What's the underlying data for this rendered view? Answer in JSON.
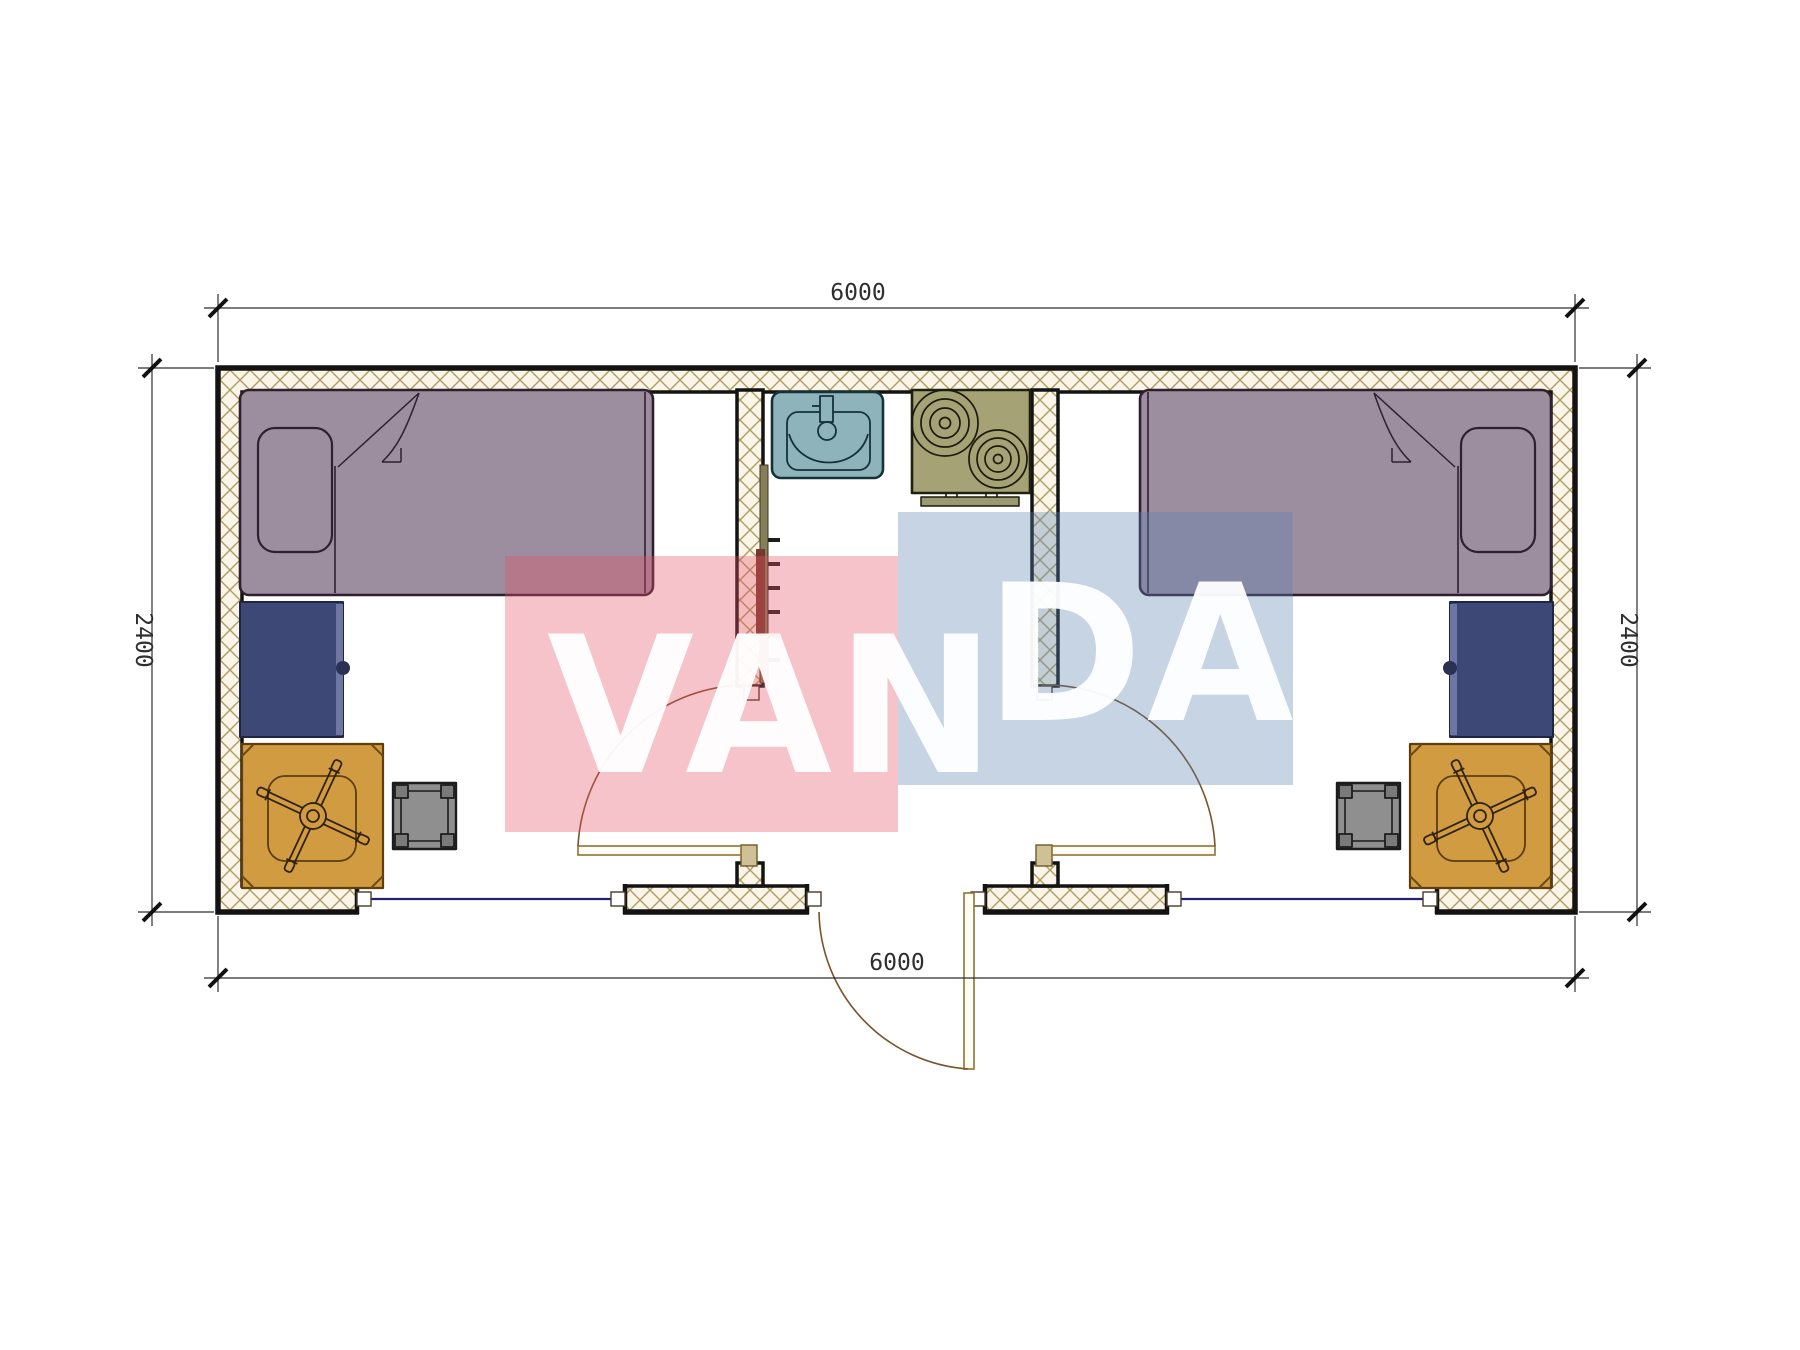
{
  "plan": {
    "dimensions": {
      "top": "6000",
      "bottom": "6000",
      "left": "2400",
      "right": "2400"
    },
    "watermark": {
      "part1": "VAN",
      "part2": "DA",
      "pink_color": "#e55468",
      "blue_color": "#5b83b1",
      "text_color": "#ffffff"
    },
    "colors": {
      "wall_hatch_line": "#ac9c67",
      "wall_fill": "#faf5e7",
      "wall_outline": "#131313",
      "bed_fill": "#9c8d9f",
      "bed_outline": "#2f1f2f",
      "cabinet_fill": "#3d4877",
      "desk_fill": "#d19c41",
      "stool_fill": "#8f8f8f",
      "sink_fill": "#8fb3ba",
      "stove_fill": "#a5a276",
      "window_line": "#23236b",
      "swing_arc": "#7a5228",
      "dimension_text": "#2e2e2e"
    }
  }
}
